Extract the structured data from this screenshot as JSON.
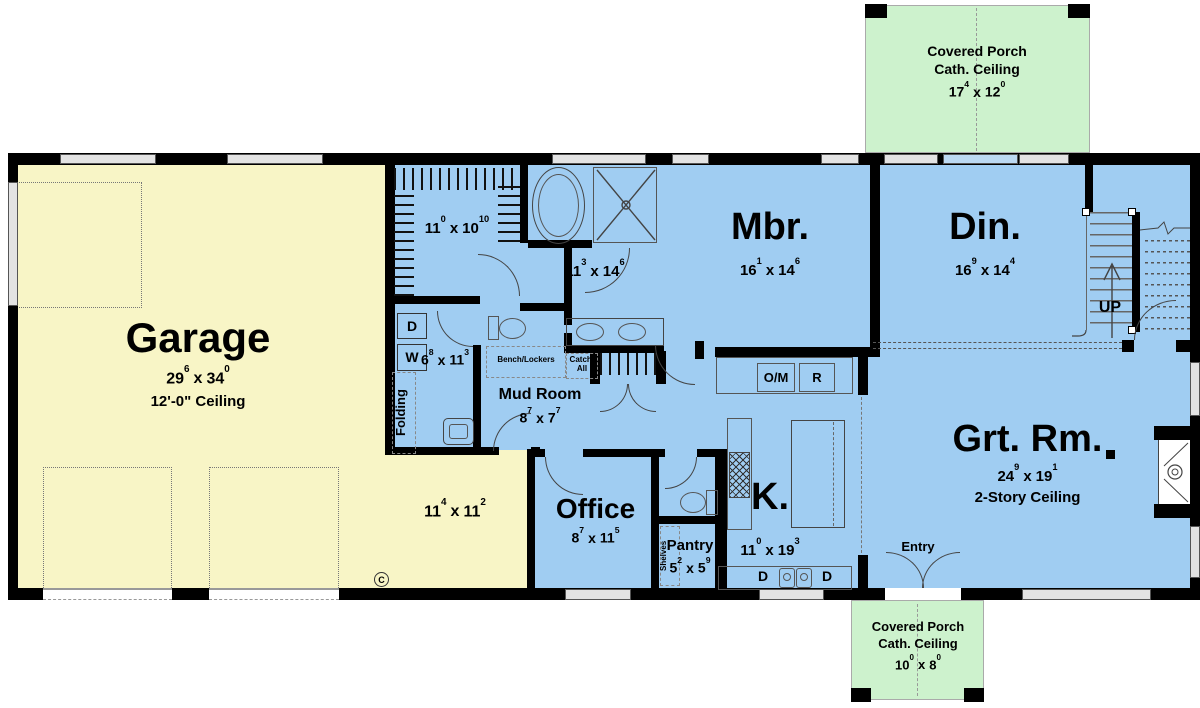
{
  "colors": {
    "garage_fill": "#f8f5c6",
    "interior_fill": "#a0cdf2",
    "porch_fill": "#cdf2cd",
    "wall": "#000000",
    "window_fill": "#e3e3e3"
  },
  "porch_top": {
    "title": "Covered Porch",
    "subtitle": "Cath. Ceiling",
    "dim": {
      "a": "17",
      "as": "4",
      "sep": "x",
      "b": "12",
      "bs": "0"
    }
  },
  "porch_bottom": {
    "title": "Covered Porch",
    "subtitle": "Cath. Ceiling",
    "dim": {
      "a": "10",
      "as": "0",
      "sep": "x",
      "b": "8",
      "bs": "0"
    }
  },
  "garage": {
    "title": "Garage",
    "dim": {
      "a": "29",
      "as": "6",
      "sep": "x",
      "b": "34",
      "bs": "0"
    },
    "ceiling_note": "12'-0\" Ceiling",
    "bay_dim": {
      "a": "11",
      "as": "4",
      "sep": "x",
      "b": "11",
      "bs": "2"
    },
    "marker": "C"
  },
  "closet": {
    "dim": {
      "a": "11",
      "as": "0",
      "sep": "x",
      "b": "10",
      "bs": "10"
    }
  },
  "bath": {
    "dim": {
      "a": "11",
      "as": "3",
      "sep": "x",
      "b": "14",
      "bs": "6"
    }
  },
  "master": {
    "title": "Mbr.",
    "dim": {
      "a": "16",
      "as": "1",
      "sep": "x",
      "b": "14",
      "bs": "6"
    }
  },
  "dining": {
    "title": "Din.",
    "dim": {
      "a": "16",
      "as": "9",
      "sep": "x",
      "b": "14",
      "bs": "4"
    }
  },
  "stairs": {
    "label": "UP"
  },
  "laundry": {
    "dim": {
      "a": "6",
      "as": "8",
      "sep": "x",
      "b": "11",
      "bs": "3"
    },
    "dryer": "D",
    "washer": "W",
    "folding": "Folding"
  },
  "mudroom": {
    "title": "Mud Room",
    "dim": {
      "a": "8",
      "as": "7",
      "sep": "x",
      "b": "7",
      "bs": "7"
    },
    "bench": "Bench/Lockers",
    "catch_line1": "Catch-",
    "catch_line2": "All"
  },
  "office": {
    "title": "Office",
    "dim": {
      "a": "8",
      "as": "7",
      "sep": "x",
      "b": "11",
      "bs": "5"
    }
  },
  "pantry": {
    "title": "Pantry",
    "dim": {
      "a": "5",
      "as": "2",
      "sep": "x",
      "b": "5",
      "bs": "9"
    },
    "shelves": "Shelves"
  },
  "kitchen": {
    "title": "K.",
    "dim": {
      "a": "11",
      "as": "0",
      "sep": "x",
      "b": "19",
      "bs": "3"
    },
    "oven_micro": "O/M",
    "fridge": "R",
    "dishwasher_left": "D",
    "dishwasher_right": "D"
  },
  "great_room": {
    "title": "Grt. Rm.",
    "dim": {
      "a": "24",
      "as": "9",
      "sep": "x",
      "b": "19",
      "bs": "1"
    },
    "ceiling_note": "2-Story Ceiling"
  },
  "entry": {
    "title": "Entry"
  }
}
